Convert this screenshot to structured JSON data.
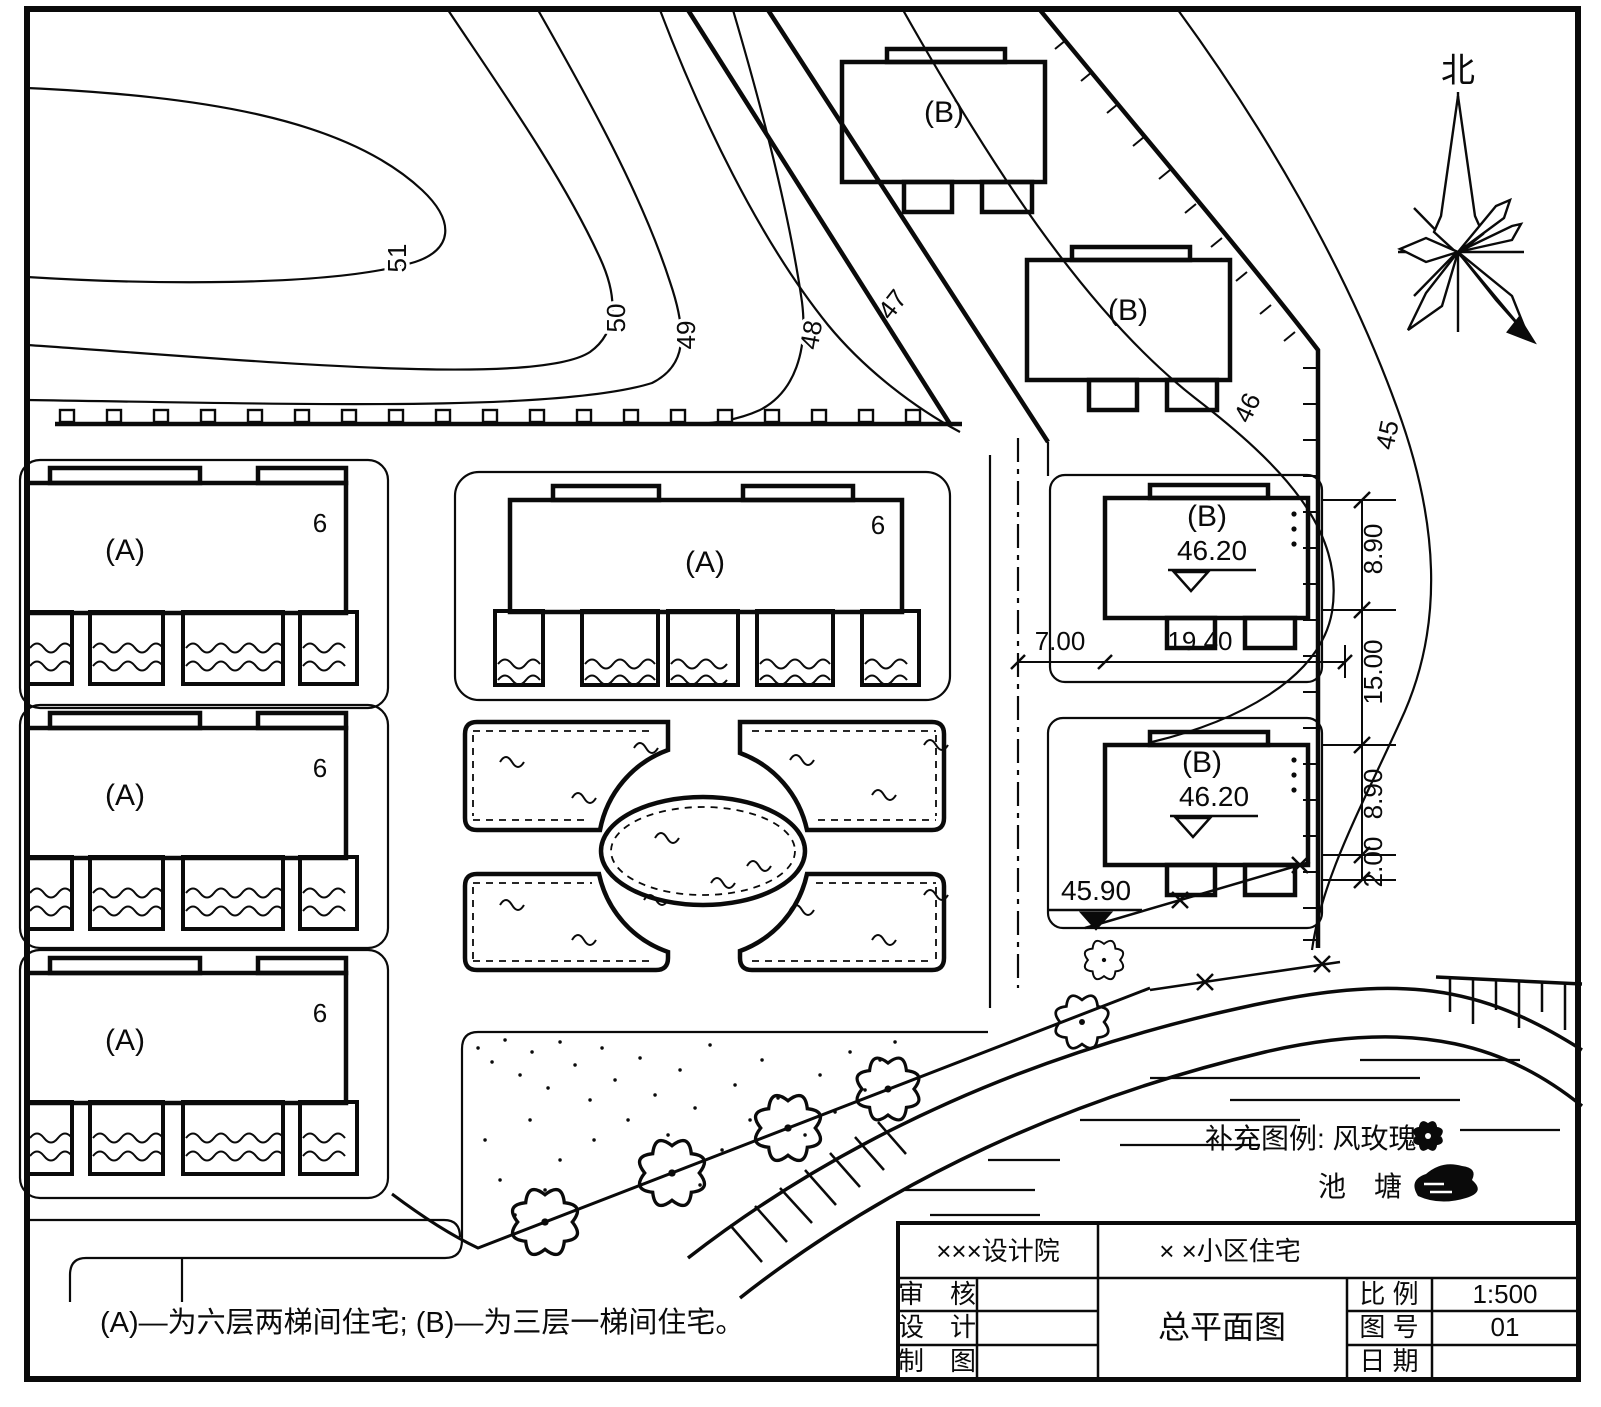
{
  "compass": {
    "north": "北"
  },
  "contours": {
    "labels": [
      "51",
      "50",
      "49",
      "48",
      "47",
      "46",
      "45"
    ]
  },
  "buildings": {
    "type_a_label": "(A)",
    "type_b_label": "(B)",
    "floors_label": "6"
  },
  "elevations": {
    "b_upper": "46.20",
    "b_lower": "46.20",
    "road": "45.90"
  },
  "dimensions": {
    "horizontal": [
      "7.00",
      "19.40"
    ],
    "vertical": [
      "8.90",
      "15.00",
      "8.90",
      "2.00"
    ]
  },
  "legend": {
    "line1": "补充图例: 风玫瑰",
    "line2": "池　塘",
    "rose_icon": "wind-rose-flower",
    "pond_icon": "pond-blob"
  },
  "note": {
    "text": "(A)—为六层两梯间住宅; (B)—为三层一梯间住宅。"
  },
  "title_block": {
    "company": "×××设计院",
    "project": "× ×小区住宅",
    "drawing_title": "总平面图",
    "review_label": "审　核",
    "design_label": "设　计",
    "draft_label": "制　图",
    "scale_label": "比 例",
    "scale_value": "1:500",
    "sheet_label": "图 号",
    "sheet_value": "01",
    "date_label": "日 期"
  }
}
